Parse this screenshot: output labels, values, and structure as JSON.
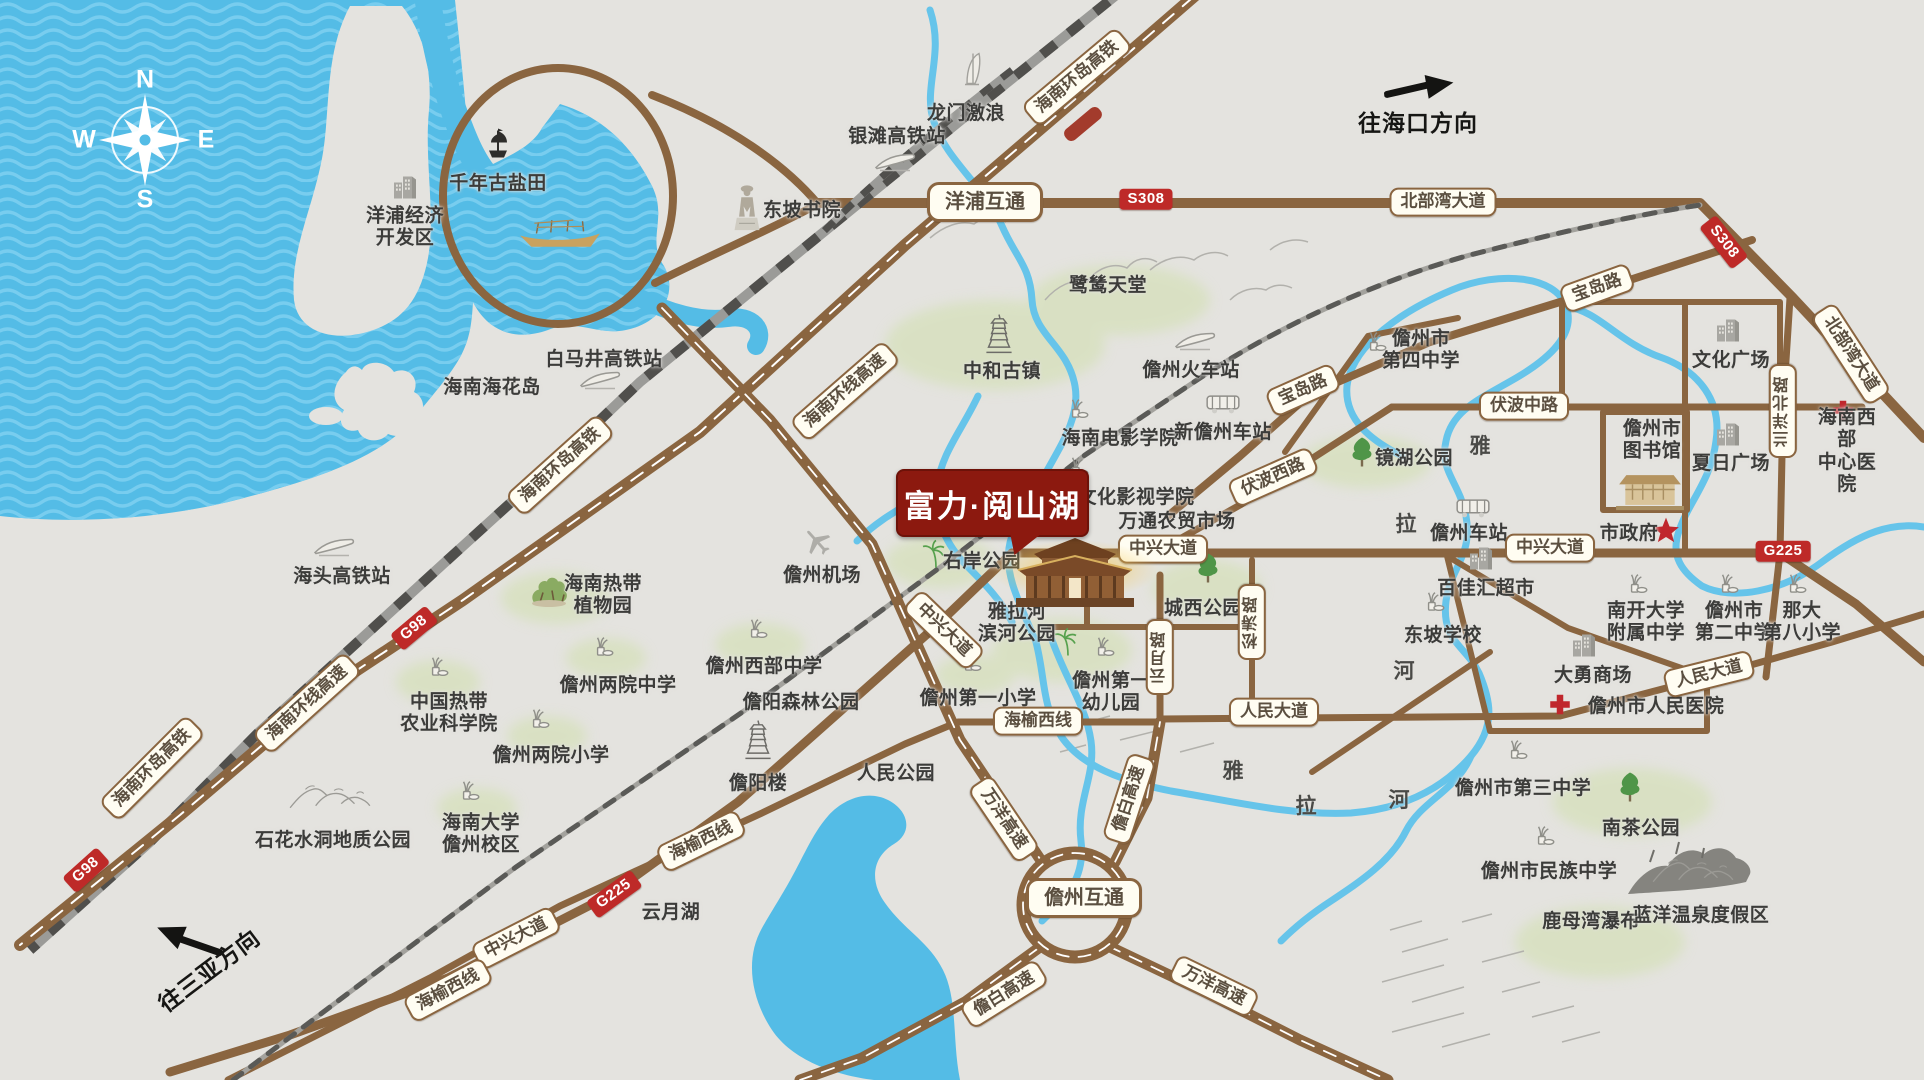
{
  "colors": {
    "sea": "#54BCE6",
    "sea_wave": "#78CDEF",
    "land": "#E4E3DF",
    "road": "#8A6540",
    "railway": "#55554F",
    "pill_bg": "#FFFDF2",
    "pill_border": "#8A6540",
    "badge_red": "#BE2A28",
    "project_red": "#8C190F",
    "river": "#66C4EA",
    "label": "#3c3c3a",
    "green_wash": "#CFDFA9"
  },
  "compass": {
    "n": "N",
    "e": "E",
    "s": "S",
    "w": "W"
  },
  "project": {
    "name": "富力·阅山湖"
  },
  "directions": [
    {
      "t": "往海口方向",
      "x": 1418,
      "y": 121,
      "rot": 0,
      "ax": 1420,
      "ay": 91,
      "arot": -5
    },
    {
      "t": "往三亚方向",
      "x": 208,
      "y": 969,
      "rot": -37,
      "ax": 190,
      "ay": 938,
      "arot": 207
    }
  ],
  "places": [
    {
      "t": "洋浦经济\n开发区",
      "x": 405,
      "y": 228,
      "i": "building-icon",
      "ix": 405,
      "iy": 188
    },
    {
      "t": "千年古盐田",
      "x": 498,
      "y": 184,
      "i": "ship-icon",
      "ix": 498,
      "iy": 146
    },
    {
      "t": "东坡书院",
      "x": 802,
      "y": 211,
      "i": "statue-icon",
      "ix": 747,
      "iy": 210
    },
    {
      "t": "龙门激浪",
      "x": 966,
      "y": 114,
      "i": "windsurf-icon",
      "ix": 972,
      "iy": 72
    },
    {
      "t": "银滩高铁站",
      "x": 897,
      "y": 137,
      "i": "train-icon",
      "ix": 895,
      "iy": 165
    },
    {
      "t": "白马井高铁站",
      "x": 604,
      "y": 360,
      "i": "train-icon",
      "ix": 600,
      "iy": 383
    },
    {
      "t": "海南海花岛",
      "x": 492,
      "y": 388
    },
    {
      "t": "海头高铁站",
      "x": 342,
      "y": 577,
      "i": "train-icon",
      "ix": 334,
      "iy": 550
    },
    {
      "t": "海南热带\n植物园",
      "x": 603,
      "y": 596,
      "i": "garden-icon",
      "ix": 549,
      "iy": 593
    },
    {
      "t": "儋州机场",
      "x": 822,
      "y": 576,
      "i": "plane-icon",
      "ix": 817,
      "iy": 544
    },
    {
      "t": "中和古镇",
      "x": 1002,
      "y": 372,
      "i": "pagoda-icon",
      "ix": 999,
      "iy": 336
    },
    {
      "t": "鹭鸶天堂",
      "x": 1108,
      "y": 286
    },
    {
      "t": "儋州火车站",
      "x": 1191,
      "y": 371,
      "i": "train-icon",
      "ix": 1195,
      "iy": 344
    },
    {
      "t": "海南电影学院",
      "x": 1120,
      "y": 439,
      "i": "plant-icon",
      "ix": 1078,
      "iy": 412
    },
    {
      "t": "新儋州车站",
      "x": 1223,
      "y": 433,
      "i": "bus-icon",
      "ix": 1223,
      "iy": 406
    },
    {
      "t": "文化影视学院",
      "x": 1136,
      "y": 498,
      "i": "plant-icon",
      "ix": 1078,
      "iy": 470
    },
    {
      "t": "万通农贸市场",
      "x": 1177,
      "y": 522
    },
    {
      "t": "右岸公园",
      "x": 982,
      "y": 562,
      "i": "palm-icon",
      "ix": 936,
      "iy": 557
    },
    {
      "t": "雅拉河\n滨河公园",
      "x": 1017,
      "y": 624,
      "i": "palm-icon",
      "ix": 1068,
      "iy": 645
    },
    {
      "t": "城西公园",
      "x": 1203,
      "y": 609,
      "i": "tree-icon",
      "ix": 1208,
      "iy": 571
    },
    {
      "t": "镜湖公园",
      "x": 1414,
      "y": 459,
      "i": "tree-icon",
      "ix": 1362,
      "iy": 455
    },
    {
      "t": "儋州市\n第四中学",
      "x": 1421,
      "y": 351,
      "i": "plant-icon",
      "ix": 1376,
      "iy": 345
    },
    {
      "t": "儋州市\n图书馆",
      "x": 1652,
      "y": 441,
      "i": "library-illustration",
      "ix": 1650,
      "iy": 492
    },
    {
      "t": "文化广场",
      "x": 1731,
      "y": 361,
      "i": "building-icon",
      "ix": 1728,
      "iy": 331
    },
    {
      "t": "夏日广场",
      "x": 1731,
      "y": 464,
      "i": "building-icon",
      "ix": 1728,
      "iy": 435
    },
    {
      "t": "海南西部\n中心医院",
      "x": 1847,
      "y": 452,
      "i": "hospital-cross-icon",
      "ix": 1843,
      "iy": 413
    },
    {
      "t": "市政府",
      "x": 1629,
      "y": 534,
      "i": "star-icon",
      "ix": 1666,
      "iy": 533
    },
    {
      "t": "儋州车站",
      "x": 1469,
      "y": 534,
      "i": "bus-icon",
      "ix": 1473,
      "iy": 510
    },
    {
      "t": "百佳汇超市",
      "x": 1486,
      "y": 589,
      "i": "building-icon",
      "ix": 1481,
      "iy": 559
    },
    {
      "t": "东坡学校",
      "x": 1443,
      "y": 636,
      "i": "plant-icon",
      "ix": 1434,
      "iy": 605
    },
    {
      "t": "南开大学\n附属中学",
      "x": 1646,
      "y": 623,
      "i": "plant-icon",
      "ix": 1637,
      "iy": 587
    },
    {
      "t": "儋州市\n第二中学",
      "x": 1734,
      "y": 623,
      "i": "plant-icon",
      "ix": 1728,
      "iy": 587
    },
    {
      "t": "那大\n第八小学",
      "x": 1802,
      "y": 623,
      "i": "plant-icon",
      "ix": 1796,
      "iy": 587
    },
    {
      "t": "大勇商场",
      "x": 1593,
      "y": 676,
      "i": "building-icon",
      "ix": 1584,
      "iy": 646
    },
    {
      "t": "儋州市人民医院",
      "x": 1656,
      "y": 707,
      "i": "hospital-cross-icon",
      "ix": 1560,
      "iy": 707
    },
    {
      "t": "中国热带\n农业科学院",
      "x": 449,
      "y": 714,
      "i": "plant-icon",
      "ix": 438,
      "iy": 670
    },
    {
      "t": "儋州两院中学",
      "x": 618,
      "y": 686,
      "i": "plant-icon",
      "ix": 603,
      "iy": 650
    },
    {
      "t": "儋州两院小学",
      "x": 551,
      "y": 756,
      "i": "plant-icon",
      "ix": 539,
      "iy": 722
    },
    {
      "t": "海南大学\n儋州校区",
      "x": 481,
      "y": 835,
      "i": "plant-icon",
      "ix": 469,
      "iy": 794
    },
    {
      "t": "石花水洞地质公园",
      "x": 333,
      "y": 841,
      "i": "mountain-icon",
      "ix": 331,
      "iy": 798
    },
    {
      "t": "儋州西部中学",
      "x": 764,
      "y": 667,
      "i": "plant-icon",
      "ix": 757,
      "iy": 632
    },
    {
      "t": "儋阳森林公园",
      "x": 801,
      "y": 703
    },
    {
      "t": "儋阳楼",
      "x": 758,
      "y": 784,
      "i": "pagoda-icon",
      "ix": 758,
      "iy": 742
    },
    {
      "t": "人民公园",
      "x": 896,
      "y": 774
    },
    {
      "t": "儋州第一小学",
      "x": 978,
      "y": 699,
      "i": "plant-icon",
      "ix": 971,
      "iy": 665
    },
    {
      "t": "儋州第一\n幼儿园",
      "x": 1111,
      "y": 693,
      "i": "plant-icon",
      "ix": 1104,
      "iy": 650
    },
    {
      "t": "云月湖",
      "x": 671,
      "y": 913
    },
    {
      "t": "儋州市第三中学",
      "x": 1523,
      "y": 789,
      "i": "plant-icon",
      "ix": 1517,
      "iy": 753
    },
    {
      "t": "南茶公园",
      "x": 1641,
      "y": 829,
      "i": "tree-icon",
      "ix": 1630,
      "iy": 790
    },
    {
      "t": "儋州市民族中学",
      "x": 1549,
      "y": 872,
      "i": "plant-icon",
      "ix": 1544,
      "iy": 839
    },
    {
      "t": "鹿母湾瀑布",
      "x": 1591,
      "y": 922
    },
    {
      "t": "蓝洋温泉度假区",
      "x": 1701,
      "y": 916,
      "i": "mountain-icon",
      "ix": 1694,
      "iy": 872
    }
  ],
  "road_pills": [
    {
      "t": "海南环岛高铁",
      "x": 1077,
      "y": 77,
      "rot": -40
    },
    {
      "t": "海南环岛高铁",
      "x": 560,
      "y": 465,
      "rot": -42
    },
    {
      "t": "海南环岛高铁",
      "x": 152,
      "y": 768,
      "rot": -45
    },
    {
      "t": "海南环线高速",
      "x": 845,
      "y": 391,
      "rot": -41
    },
    {
      "t": "海南环线高速",
      "x": 307,
      "y": 703,
      "rot": -42
    },
    {
      "t": "洋浦互通",
      "x": 985,
      "y": 202,
      "rot": 0,
      "big": true
    },
    {
      "t": "儋州互通",
      "x": 1084,
      "y": 898,
      "rot": 0,
      "big": true
    },
    {
      "t": "北部湾大道",
      "x": 1443,
      "y": 202,
      "rot": 0
    },
    {
      "t": "北部湾大道",
      "x": 1851,
      "y": 354,
      "rot": 57
    },
    {
      "t": "宝岛路",
      "x": 1303,
      "y": 390,
      "rot": -24
    },
    {
      "t": "宝岛路",
      "x": 1597,
      "y": 288,
      "rot": -20
    },
    {
      "t": "伏波中路",
      "x": 1524,
      "y": 406,
      "rot": 0
    },
    {
      "t": "伏波西路",
      "x": 1273,
      "y": 477,
      "rot": -24
    },
    {
      "t": "中兴大道",
      "x": 1163,
      "y": 549,
      "rot": 0
    },
    {
      "t": "中兴大道",
      "x": 1550,
      "y": 548,
      "rot": 0
    },
    {
      "t": "中兴大道",
      "x": 944,
      "y": 630,
      "rot": 44
    },
    {
      "t": "中兴大道",
      "x": 516,
      "y": 938,
      "rot": -27
    },
    {
      "t": "人民大道",
      "x": 1274,
      "y": 712,
      "rot": 0
    },
    {
      "t": "人民大道",
      "x": 1709,
      "y": 674,
      "rot": -14
    },
    {
      "t": "海榆西线",
      "x": 1038,
      "y": 721,
      "rot": 0
    },
    {
      "t": "海榆西线",
      "x": 701,
      "y": 841,
      "rot": -26
    },
    {
      "t": "海榆西线",
      "x": 448,
      "y": 990,
      "rot": -28
    },
    {
      "t": "云月路",
      "x": 1160,
      "y": 657,
      "vert": true
    },
    {
      "t": "松涛路",
      "x": 1252,
      "y": 622,
      "vert": true
    },
    {
      "t": "兰洋北路",
      "x": 1783,
      "y": 411,
      "vert": true
    },
    {
      "t": "万洋高速",
      "x": 1004,
      "y": 819,
      "rot": 56
    },
    {
      "t": "万洋高速",
      "x": 1214,
      "y": 986,
      "rot": 26
    },
    {
      "t": "儋白高速",
      "x": 1129,
      "y": 799,
      "rot": -72
    },
    {
      "t": "儋白高速",
      "x": 1004,
      "y": 994,
      "rot": -32
    }
  ],
  "badges": [
    {
      "t": "S308",
      "x": 1146,
      "y": 199,
      "rot": 0
    },
    {
      "t": "S308",
      "x": 1724,
      "y": 242,
      "rot": 52
    },
    {
      "t": "G98",
      "x": 414,
      "y": 628,
      "rot": -40
    },
    {
      "t": "G98",
      "x": 86,
      "y": 870,
      "rot": -42
    },
    {
      "t": "G225",
      "x": 1783,
      "y": 551,
      "rot": 0
    },
    {
      "t": "G225",
      "x": 614,
      "y": 894,
      "rot": -36
    }
  ],
  "river_labels": [
    {
      "ch": "雅",
      "x": 1480,
      "y": 445
    },
    {
      "ch": "拉",
      "x": 1406,
      "y": 523
    },
    {
      "ch": "河",
      "x": 1404,
      "y": 670
    },
    {
      "ch": "雅",
      "x": 1233,
      "y": 770
    },
    {
      "ch": "拉",
      "x": 1306,
      "y": 805
    },
    {
      "ch": "河",
      "x": 1399,
      "y": 799
    }
  ]
}
